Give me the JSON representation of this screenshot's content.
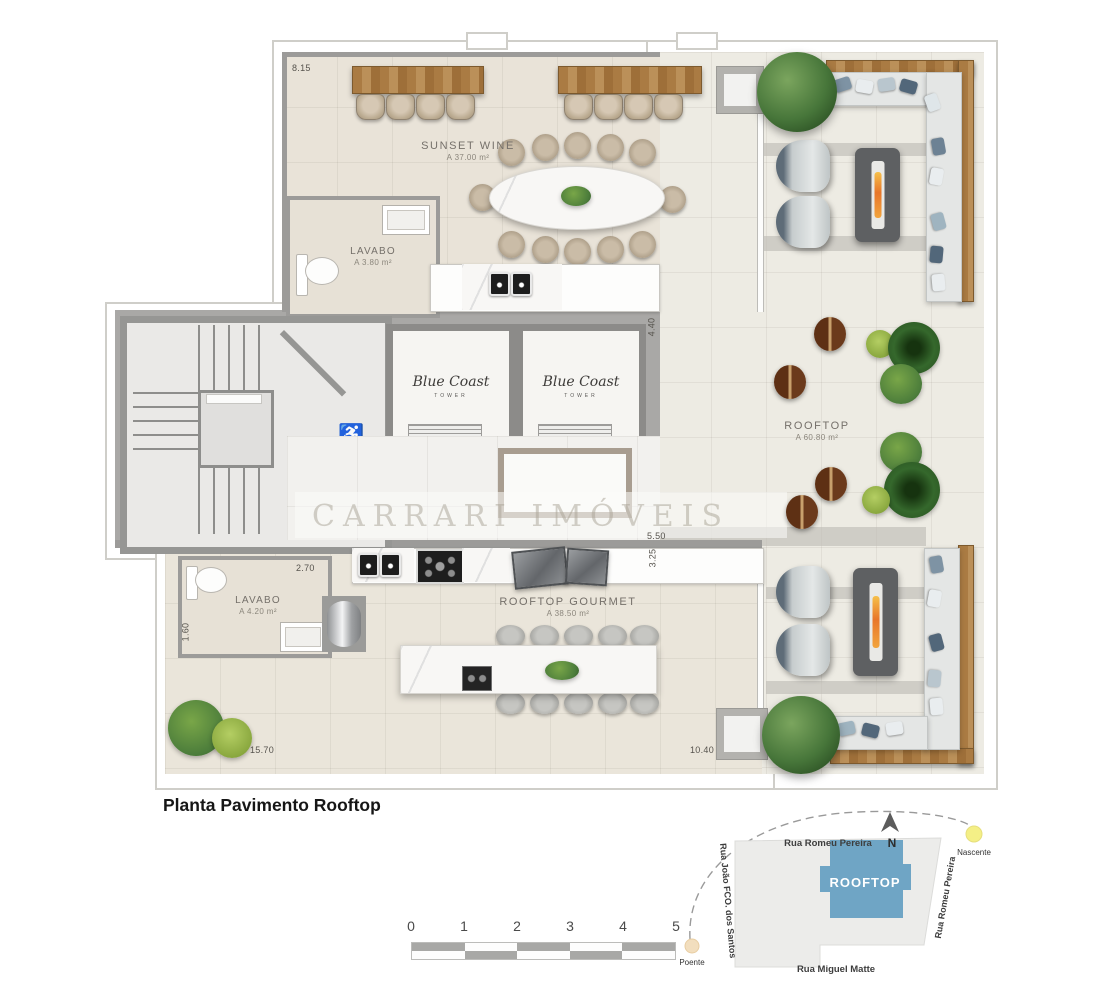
{
  "title": "Planta Pavimento Rooftop",
  "watermark": "CARRARI IMÓVEIS",
  "rooms": {
    "sunset_wine": {
      "name": "SUNSET WINE",
      "area": "A 37.00 m²"
    },
    "lavabo_top": {
      "name": "LAVABO",
      "area": "A 3.80 m²"
    },
    "rooftop": {
      "name": "ROOFTOP",
      "area": "A 60.80 m²"
    },
    "lavabo_bottom": {
      "name": "LAVABO",
      "area": "A 4.20 m²"
    },
    "rooftop_gourmet": {
      "name": "ROOFTOP GOURMET",
      "area": "A 38.50 m²"
    }
  },
  "elevators": {
    "brand": "Blue Coast",
    "sub": "TOWER"
  },
  "dims": {
    "top_width": "8.15",
    "core_height": "4.40",
    "mid_width": "5.50",
    "mid_height": "3.25",
    "lavabo_width": "2.70",
    "lavabo_height": "1.60",
    "bottom_left_width": "15.70",
    "bottom_right_width": "10.40"
  },
  "scale": {
    "ticks": [
      "0",
      "1",
      "2",
      "3",
      "4",
      "5"
    ]
  },
  "site": {
    "building_label": "ROOFTOP",
    "streets": {
      "top": "Rua Romeu Pereira",
      "left": "Rua João FCO. dos Santos",
      "right": "Rua Romeu Pereira",
      "bottom": "Rua Miguel Matte"
    },
    "compass_n": "N",
    "east_label": "Nascente",
    "west_label": "Poente"
  },
  "colors": {
    "site_building": "#6fa5c5",
    "flame": "#e8762a",
    "wood": "#aa7b43",
    "core_gray": "#a9a8a6"
  }
}
